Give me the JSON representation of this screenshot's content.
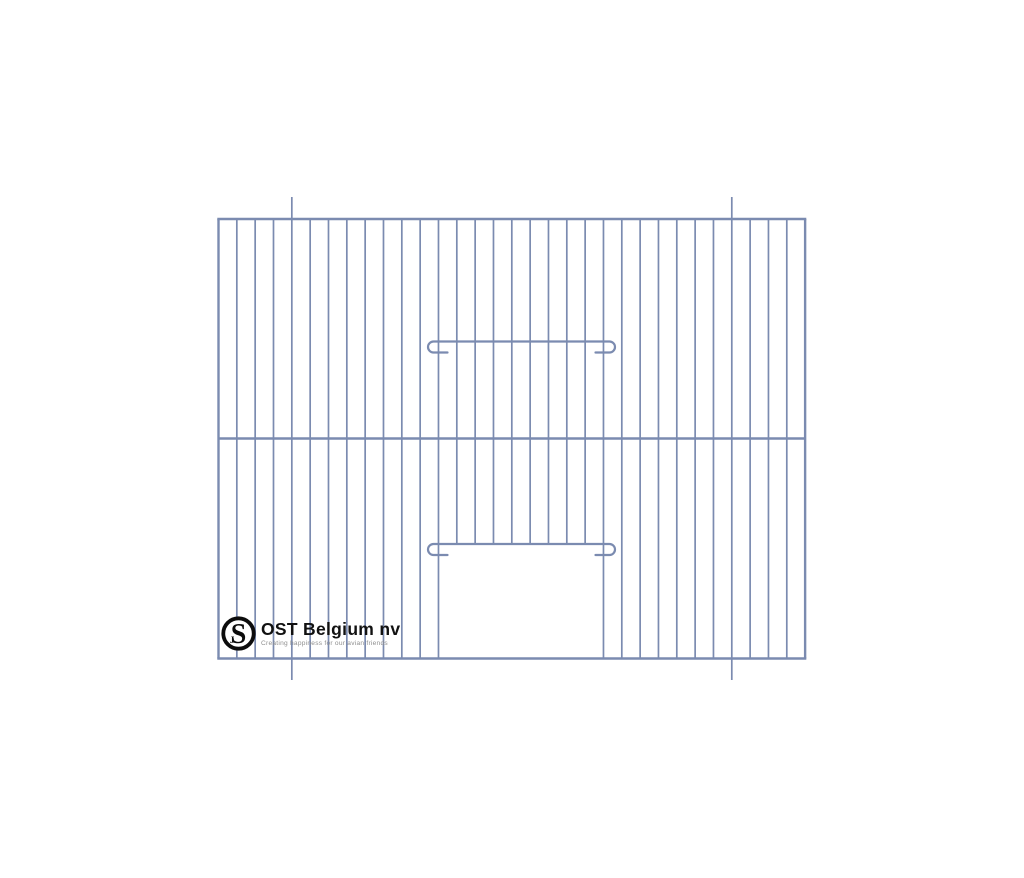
{
  "page": {
    "background": "#ffffff",
    "width": 1024,
    "height": 878,
    "content_type": "product line drawing of a wire bird-cage front panel"
  },
  "drawing": {
    "description": "Bird cage front panel: evenly spaced vertical wires, one middle crossbar, two hooked slide bars and a bottom-center door opening, with four mounting wire stubs protruding past the frame",
    "wire_color": "#7b8bb0",
    "frame": {
      "left": 218.5,
      "top": 219,
      "right": 805.1,
      "bottom": 658.5
    },
    "wires": {
      "count": 33,
      "spacing": 18.332
    },
    "middle_crossbar_y": 438.5,
    "door": {
      "opening_left_wire_index": 12,
      "opening_right_wire_index": 21,
      "opening_top_y": 544,
      "top_bar": {
        "y": 341.5,
        "x1": 433.5,
        "x2": 609.5
      },
      "bottom_bar": {
        "y": 544,
        "x1": 433.5,
        "x2": 609.5
      },
      "hook_radius": 5.5,
      "hook_drop": 11,
      "hook_stub": 14
    },
    "mounting_wires": {
      "wire_indices": [
        4,
        28
      ],
      "top_y": 197,
      "bottom_y": 680
    },
    "stroke_widths": {
      "wire": 1.7,
      "frame": 2.4,
      "bar": 2.2
    }
  },
  "logo": {
    "brand": "OST Belgium nv",
    "tagline": "Creating happiness for our avian friends",
    "mark_letter": "S",
    "mark_letter_secondary": "J",
    "mark_color": "#0c0c0c",
    "text_color": "#111111",
    "tagline_color": "#8f8f8f"
  }
}
